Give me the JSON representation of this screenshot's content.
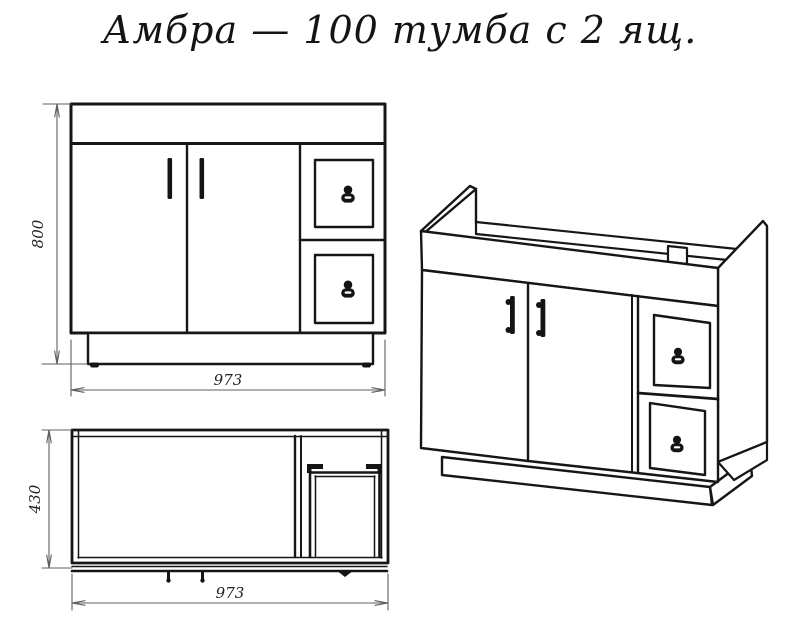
{
  "title": "Амбра — 100 тумба с 2 ящ.",
  "colors": {
    "background": "#ffffff",
    "drawing_line": "#161616",
    "dimension_line": "#5f5f5f",
    "dimension_text": "#222222"
  },
  "views": {
    "front": {
      "height": "800",
      "width": "973"
    },
    "plan": {
      "depth": "430",
      "width": "973"
    }
  }
}
